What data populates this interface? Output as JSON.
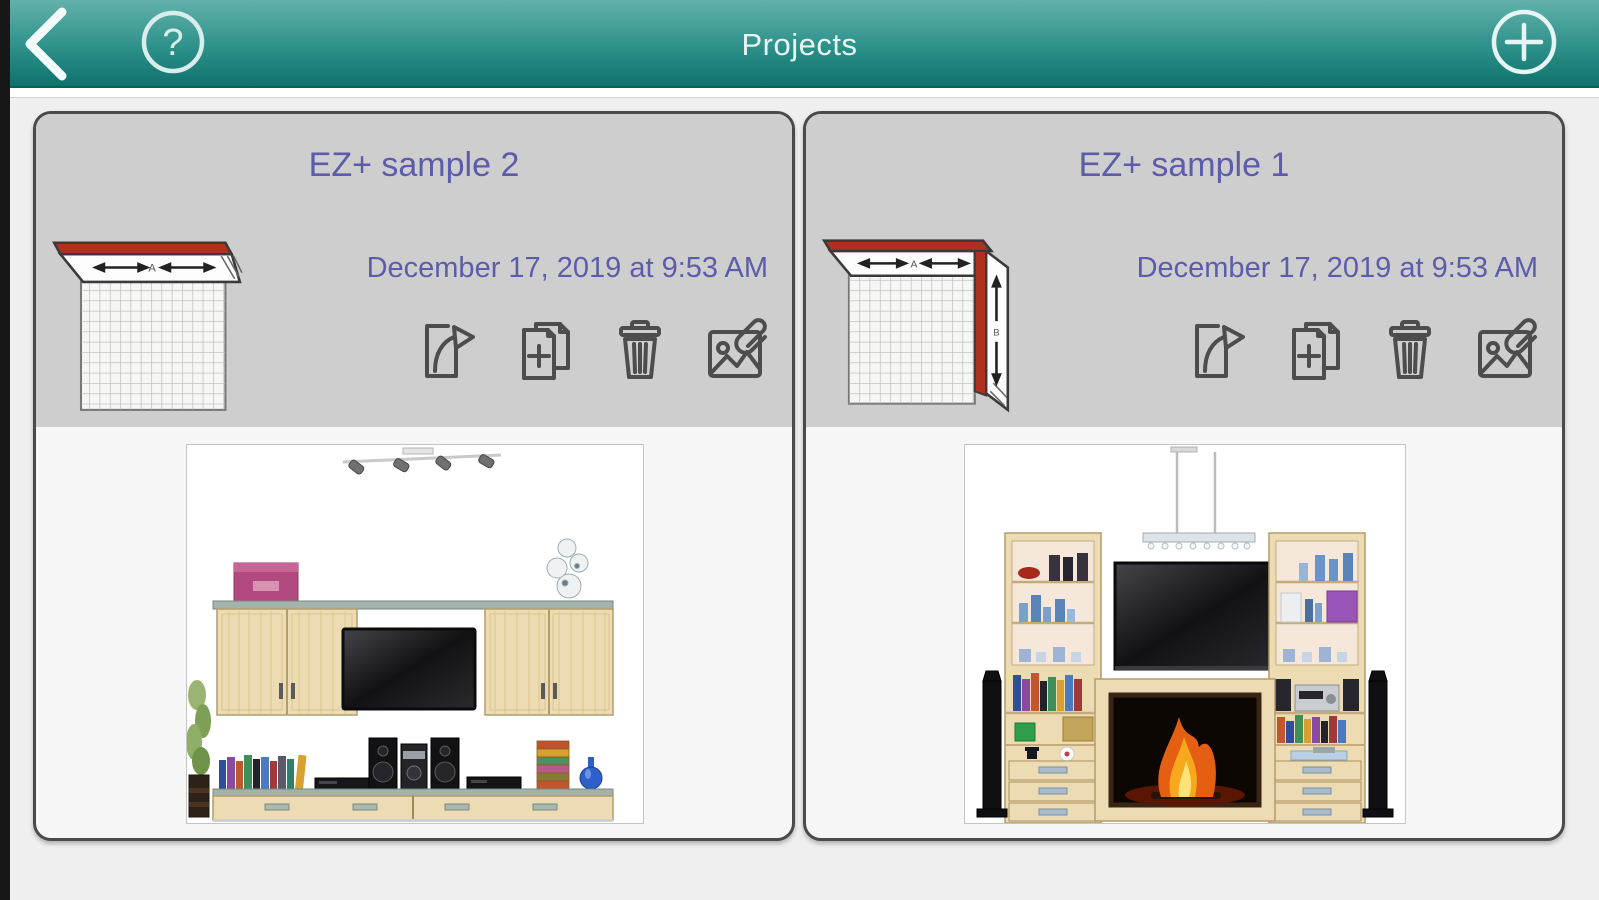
{
  "theme": {
    "nav_teal_top": "#63b2ab",
    "nav_teal_bottom": "#0e716c",
    "header_gray": "#cecece",
    "card_border": "#4a4a4a",
    "accent_purple": "#5c5caa",
    "wall_red": "#b03020",
    "background": "#efefef"
  },
  "nav": {
    "title": "Projects",
    "back_icon": "chevron-left",
    "help_glyph": "?",
    "add_glyph": "+"
  },
  "projects": [
    {
      "title": "EZ+ sample 2",
      "date": "December 17, 2019 at 9:53 AM",
      "plan": {
        "type": "single-wall-elevation",
        "wall_a_label": "A"
      },
      "preview": "wall unit with two wall cabinets, TV, stereo, base drawers"
    },
    {
      "title": "EZ+ sample 1",
      "date": "December 17, 2019 at 9:53 AM",
      "plan": {
        "type": "corner-wall-elevation",
        "wall_a_label": "A",
        "wall_b_label": "B"
      },
      "preview": "fireplace entertainment wall with TV, bookcase towers, floor speakers"
    }
  ],
  "card_actions": [
    {
      "name": "share-project",
      "icon": "share-arrow-icon"
    },
    {
      "name": "duplicate-project",
      "icon": "duplicate-plus-icon"
    },
    {
      "name": "delete-project",
      "icon": "trash-icon"
    },
    {
      "name": "edit-photo",
      "icon": "photo-paperclip-icon"
    }
  ]
}
